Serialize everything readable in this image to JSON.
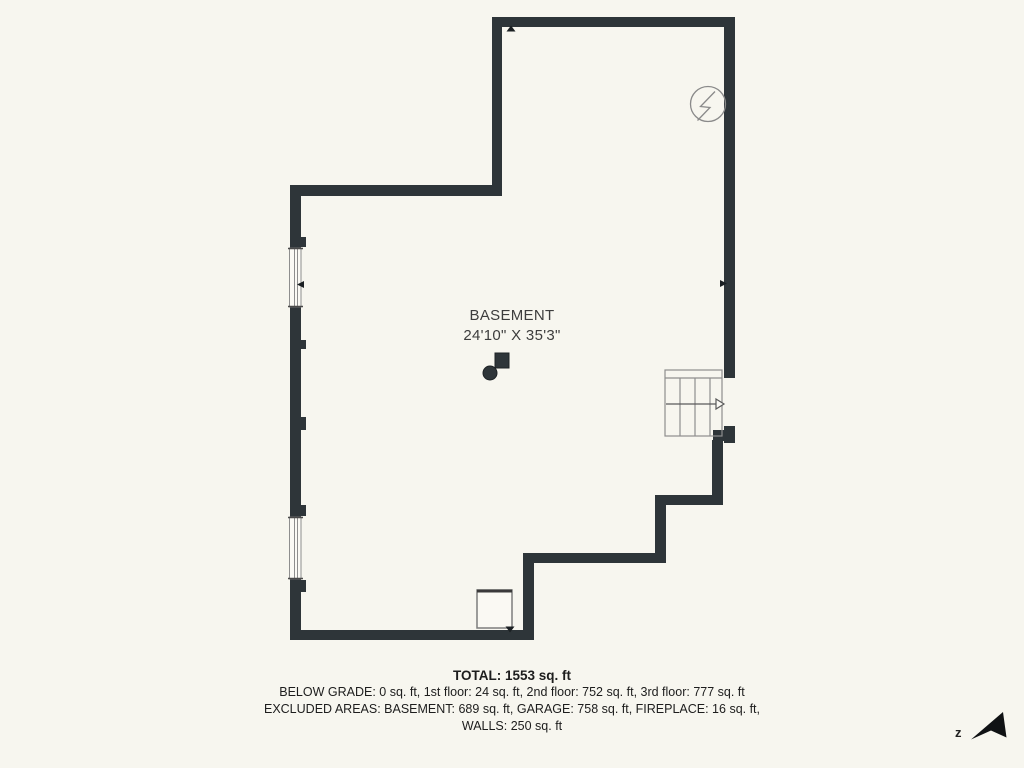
{
  "title": "Basement floor plan",
  "room": {
    "name": "BASEMENT",
    "dimensions": "24'10\" X 35'3\""
  },
  "summary": {
    "total": "TOTAL: 1553 sq. ft",
    "line2": "BELOW GRADE: 0 sq. ft, 1st floor: 24 sq. ft, 2nd floor: 752 sq. ft, 3rd floor: 777 sq. ft",
    "line3": "EXCLUDED AREAS: BASEMENT: 689 sq. ft, GARAGE: 758 sq. ft, FIREPLACE: 16 sq. ft,",
    "line4": "WALLS: 250 sq. ft"
  },
  "compass": {
    "label": "z"
  },
  "icons": {
    "electrical": "lightning-circle-icon",
    "stairs": "staircase-with-up-arrow",
    "furnace": "furnace-square",
    "support": "column-and-water-heater",
    "north": "north-arrow-dart",
    "view_markers": [
      "arrow-up",
      "arrow-right",
      "arrow-left",
      "arrow-down"
    ]
  },
  "colors": {
    "background": "#f7f6ef",
    "wall": "#2e3539",
    "thin_outline": "#8e8e8e",
    "room_text": "#3d3d3d",
    "summary_text": "#1d1d1d",
    "marker": "#1a1f22"
  }
}
